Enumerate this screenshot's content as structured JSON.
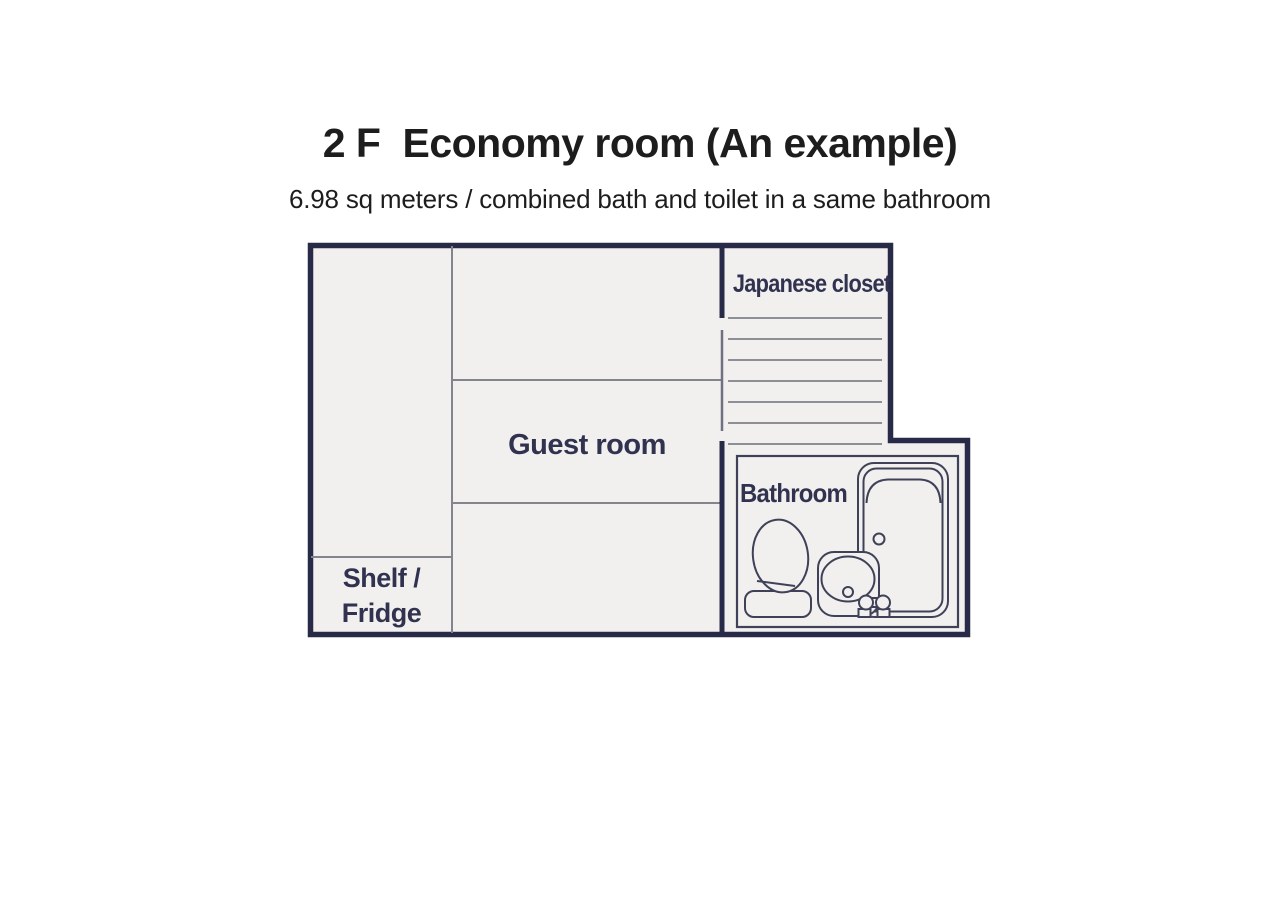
{
  "header": {
    "floor_label": "2 F",
    "title": "Economy room (An example)",
    "subtitle": "6.98 sq meters / combined bath and toilet in a same bathroom"
  },
  "floor_plan": {
    "labels": {
      "japanese_closet": "Japanese closet",
      "guest_room": "Guest room",
      "bathroom": "Bathroom",
      "shelf_fridge": {
        "line1": "Shelf /",
        "line2": "Fridge"
      }
    },
    "fixtures": {
      "bathtub": "bathtub-icon",
      "sink": "sink-icon",
      "toilet": "toilet-icon",
      "faucet": "faucet-icon",
      "closet_shelves": "closet-shelf-lines-icon"
    },
    "colors": {
      "wall": "#282b47",
      "room_fill": "#f1f0ee",
      "partition_line": "#84848e",
      "closet_shelf_line": "#7f808a",
      "closet_door_line": "#6f7080",
      "fixture_line": "#3f4158",
      "label_text": "#303250",
      "heading_text": "#1d1d1d",
      "page_background": "#ffffff"
    }
  }
}
